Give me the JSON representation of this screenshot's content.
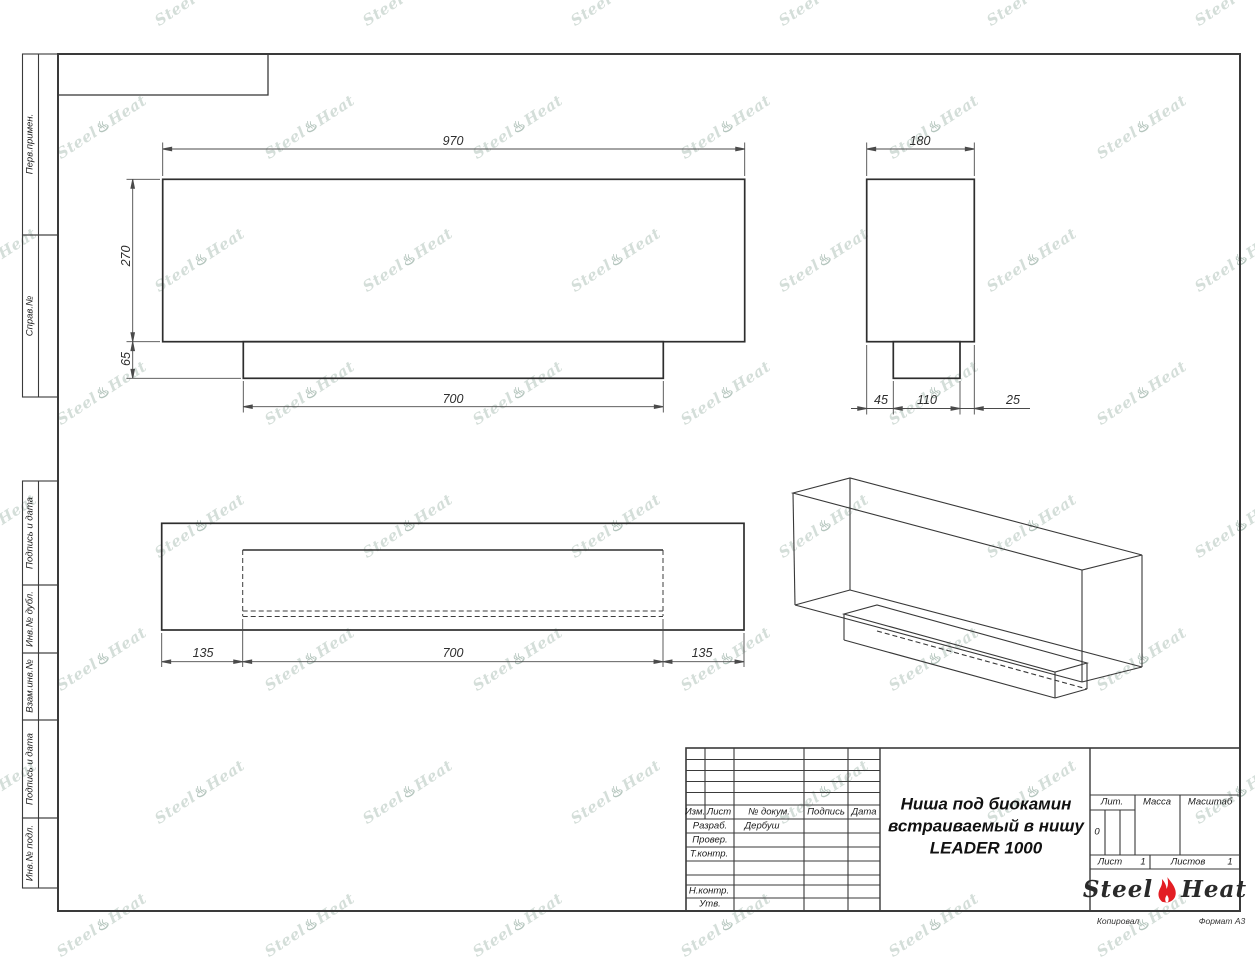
{
  "watermark": {
    "steel": "Steel",
    "flame": "♨",
    "heat": "Heat"
  },
  "sidebar": {
    "items": [
      {
        "label": "Перв.примен."
      },
      {
        "label": "Справ.№"
      },
      {
        "label": "Подпись и дата"
      },
      {
        "label": "Инв.№ дубл."
      },
      {
        "label": "Взам.инв.№"
      },
      {
        "label": "Подпись и дата"
      },
      {
        "label": "Инв.№ подл."
      }
    ]
  },
  "dimensions": {
    "front_width": "970",
    "front_height": "270",
    "base_height": "65",
    "base_width": "700",
    "side_depth": "180",
    "side_front_offset": "45",
    "side_niche_depth": "110",
    "side_back_offset": "25",
    "plan_left_offset": "135",
    "plan_opening_width": "700",
    "plan_right_offset": "135"
  },
  "title_block": {
    "col_izm": "Изм.",
    "col_list": "Лист",
    "col_doc": "№ докум.",
    "col_sign": "Подпись",
    "col_date": "Дата",
    "row_developed": "Разраб.",
    "row_developed_value": "Дербуш",
    "row_checked": "Провер.",
    "row_tcontrol": "Т.контр.",
    "row_ncontrol": "Н.контр.",
    "row_approved": "Утв.",
    "title_line1": "Ниша под биокамин",
    "title_line2": "встраиваемый в нишу",
    "title_line3": "LEADER 1000",
    "lit_label": "Лит.",
    "lit_value": "0",
    "mass_label": "Масса",
    "scale_label": "Масштаб",
    "sheet_label": "Лист",
    "sheet_value": "1",
    "sheets_label": "Листов",
    "sheets_value": "1",
    "logo_steel": "Steel",
    "logo_heat": "Heat",
    "flame_color": "#e31e24"
  },
  "footer": {
    "copied_label": "Копировал",
    "format_label": "Формат А3"
  }
}
